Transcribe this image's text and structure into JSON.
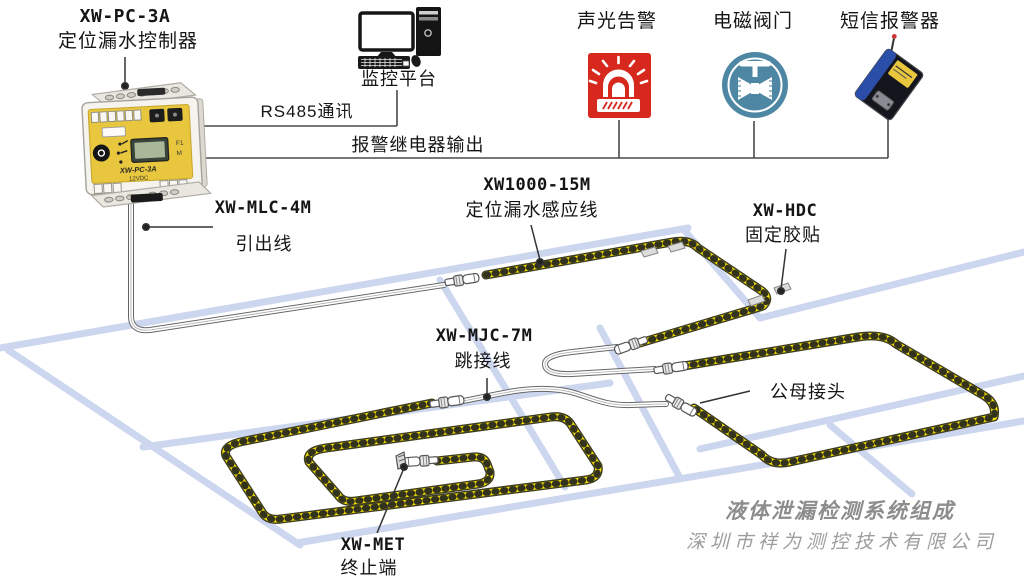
{
  "diagram": {
    "controller": {
      "model": "XW-PC-3A",
      "name": "定位漏水控制器",
      "panel_model": "XW-PC-3A",
      "panel_voltage": "12VDC",
      "panel_btn1": "F1",
      "panel_btn2": "M"
    },
    "monitor_platform": {
      "label": "监控平台"
    },
    "links": {
      "rs485": "RS485通讯",
      "relay_output": "报警继电器输出"
    },
    "alarm_outputs": {
      "sound_light": "声光告警",
      "valve": "电磁阀门",
      "sms": "短信报警器"
    },
    "leadout": {
      "model": "XW-MLC-4M",
      "name": "引出线"
    },
    "sensing_cable": {
      "model": "XW1000-15M",
      "name": "定位漏水感应线"
    },
    "tape": {
      "model": "XW-HDC",
      "name": "固定胶贴"
    },
    "jumper": {
      "model": "XW-MJC-7M",
      "name": "跳接线"
    },
    "connector": {
      "name": "公母接头"
    },
    "terminator": {
      "model": "XW-MET",
      "name": "终止端"
    }
  },
  "footer": {
    "title": "液体泄漏检测系统组成",
    "company": "深圳市祥为测控技术有限公司"
  },
  "colors": {
    "cable_yellow": "#F5E002",
    "cable_outline": "#3C3C20",
    "floor_line": "#CCD6EE",
    "alarm_red": "#D6281C",
    "valve_teal": "#4E87A3",
    "panel_yellow": "#E8C63E",
    "footer_gray": "#9D9D9D",
    "line_gray": "#4A4A4A"
  }
}
